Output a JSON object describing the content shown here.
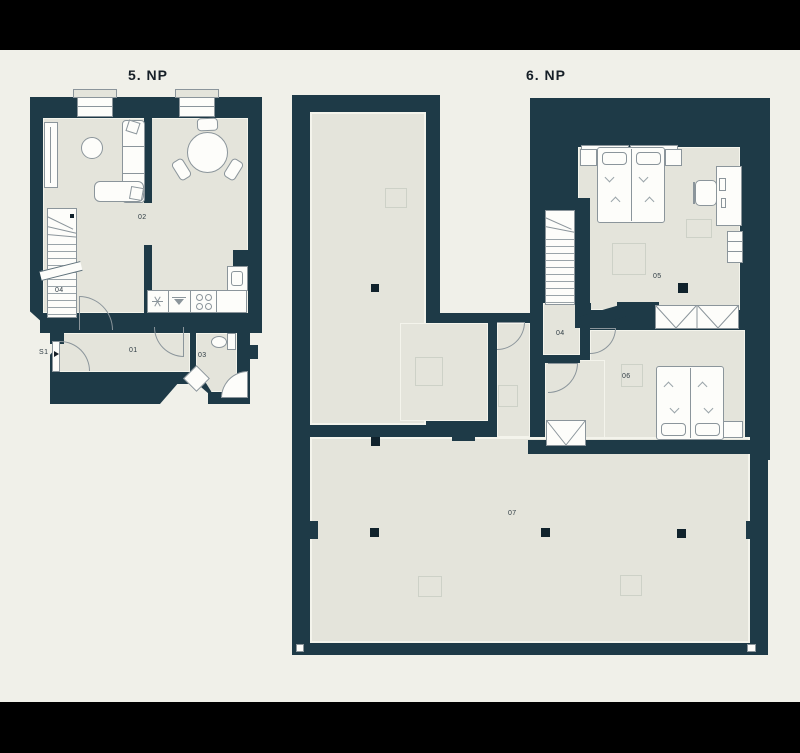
{
  "colors": {
    "letterbox": "#000000",
    "canvas_background": "#f0f0e9",
    "wall": "#1e3a47",
    "floor": "#e4e4db",
    "furniture_outline": "#8b959b",
    "label_text": "#2f3c44"
  },
  "floors": [
    {
      "name": "5. NP",
      "rooms": [
        {
          "id": "02"
        },
        {
          "id": "04"
        },
        {
          "id": "01"
        },
        {
          "id": "03"
        }
      ],
      "entrance": {
        "label": "S1"
      }
    },
    {
      "name": "6. NP",
      "rooms": [
        {
          "id": "05"
        },
        {
          "id": "04"
        },
        {
          "id": "06"
        },
        {
          "id": "07"
        }
      ]
    }
  ]
}
